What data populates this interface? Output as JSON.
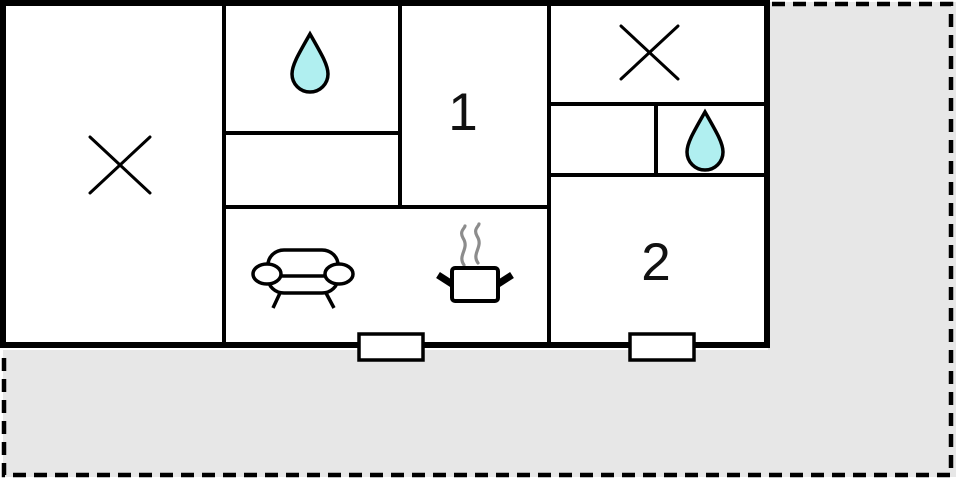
{
  "floorplan": {
    "description": "floor-plan-diagram",
    "room_labels": {
      "room1": "1",
      "room2": "2"
    },
    "symbols": [
      {
        "name": "cross-mark-icon",
        "location": "left-room"
      },
      {
        "name": "water-drop-icon",
        "location": "top-middle-room"
      },
      {
        "name": "cross-mark-icon",
        "location": "top-right-room"
      },
      {
        "name": "water-drop-icon",
        "location": "right-small-room"
      },
      {
        "name": "sofa-icon",
        "location": "living-area"
      },
      {
        "name": "cooking-pot-icon",
        "location": "kitchen-area"
      },
      {
        "name": "window-marker",
        "location": "bottom-wall-left"
      },
      {
        "name": "window-marker",
        "location": "bottom-wall-right"
      }
    ],
    "colors": {
      "wall": "#000000",
      "room_fill": "#ffffff",
      "terrace_fill": "#e7e7e7",
      "water_drop_fill": "#b0eff0",
      "steam": "#8c8c8c",
      "label_text": "#111111"
    }
  }
}
